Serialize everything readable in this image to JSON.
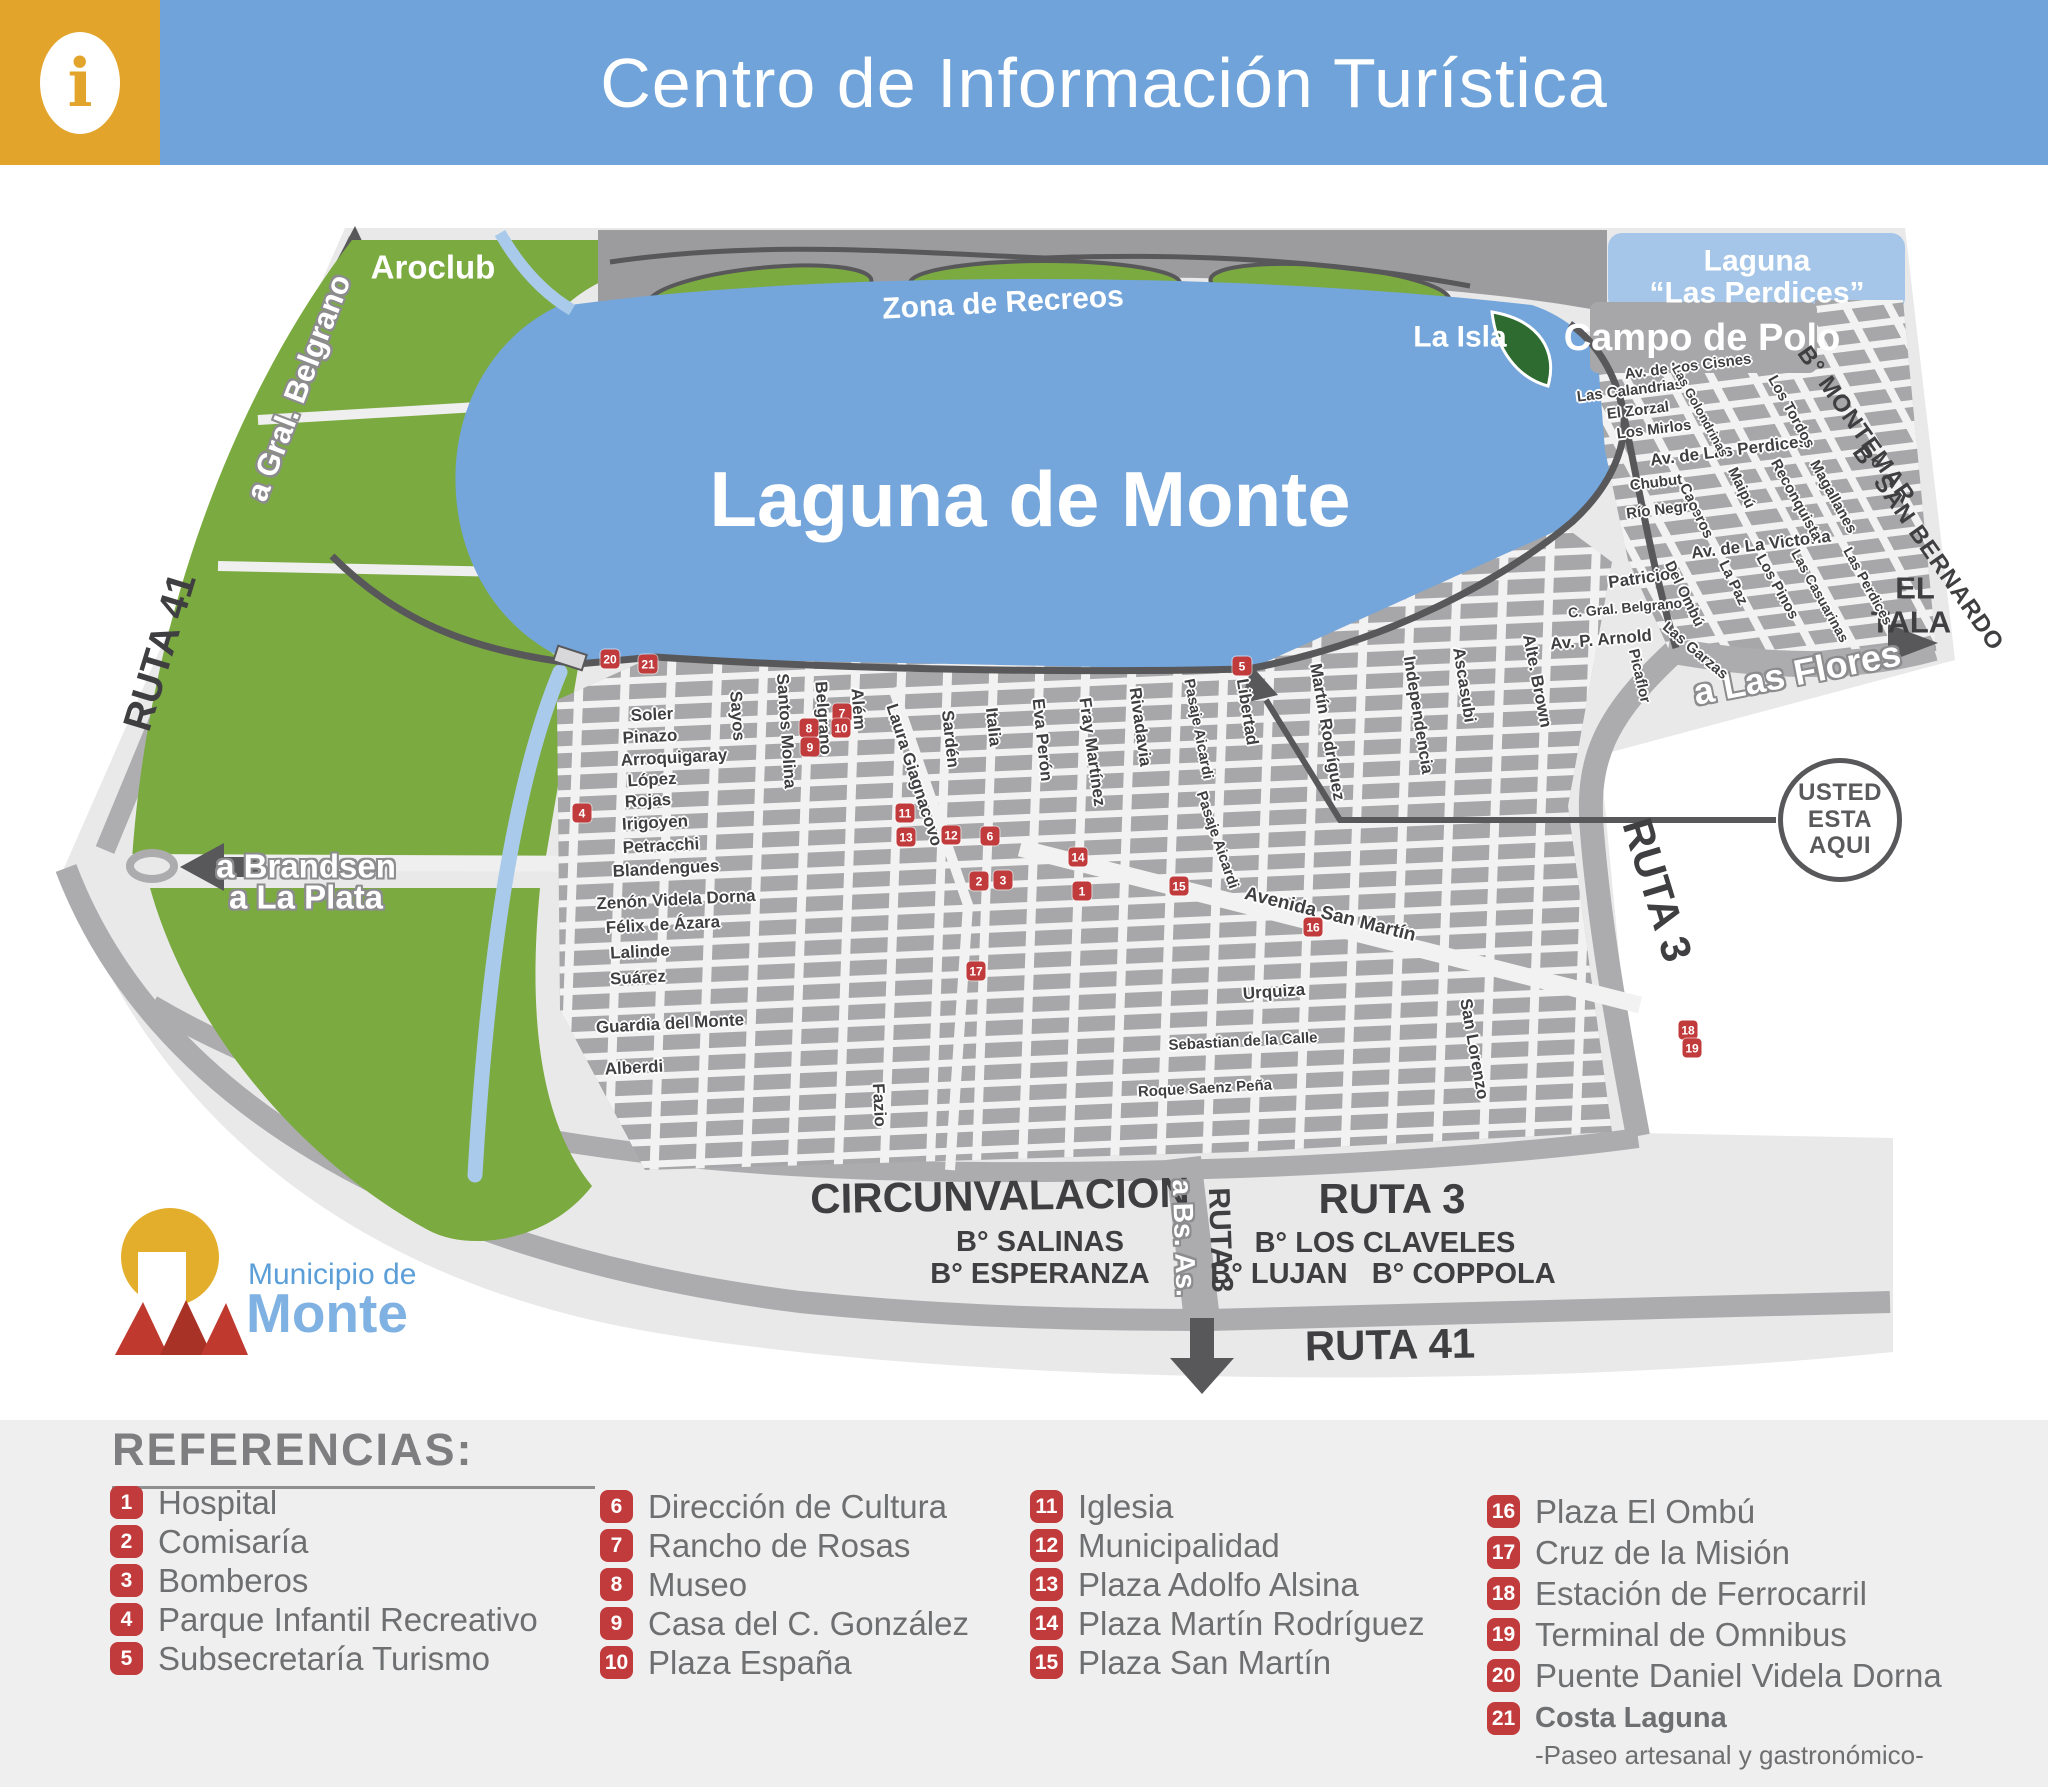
{
  "header": {
    "title": "Centro de Información Turística",
    "info_icon": "i"
  },
  "logo": {
    "line1": "Municipio de",
    "line2": "Monte"
  },
  "colors": {
    "header_blue": "#6FA3D9",
    "info_yellow": "#E2A42B",
    "lake_blue": "#74A6DB",
    "perdices_blue": "#A5C6E9",
    "park_green": "#7BAA40",
    "isla_green": "#2E6B31",
    "block_gray": "#A7A7A9",
    "plate_gray": "#E9E9EA",
    "road_dark": "#58585A",
    "marker_red": "#C23B3C",
    "legend_bg": "#EFEFEF",
    "legend_text": "#6E6F71"
  },
  "map": {
    "you_are_here": [
      "USTED",
      "ESTA",
      "AQUI"
    ],
    "labels": [
      {
        "t": "Laguna de Monte",
        "x": 1030,
        "y": 500,
        "r": 0,
        "s": 78,
        "c": "lw"
      },
      {
        "t": "Zona de Recreos",
        "x": 1003,
        "y": 303,
        "r": -3,
        "s": 30,
        "c": "lw"
      },
      {
        "t": "Aroclub",
        "x": 433,
        "y": 268,
        "r": 0,
        "s": 33,
        "c": "lw"
      },
      {
        "t": "La Isla",
        "x": 1460,
        "y": 337,
        "r": 0,
        "s": 30,
        "c": "lw"
      },
      {
        "t": "Laguna",
        "x": 1757,
        "y": 261,
        "r": 0,
        "s": 30,
        "c": "lw"
      },
      {
        "t": "“Las Perdices”",
        "x": 1757,
        "y": 293,
        "r": 0,
        "s": 30,
        "c": "lw"
      },
      {
        "t": "Campo de Polo",
        "x": 1702,
        "y": 339,
        "r": 0,
        "s": 38,
        "c": "lw"
      },
      {
        "t": "RUTA 41",
        "x": 160,
        "y": 652,
        "r": -73,
        "s": 40,
        "c": "rt"
      },
      {
        "t": "RUTA 3",
        "x": 1657,
        "y": 890,
        "r": 73,
        "s": 42,
        "c": "rt"
      },
      {
        "t": "CIRCUNVALACION",
        "x": 1000,
        "y": 1196,
        "r": -1,
        "s": 42,
        "c": "rt"
      },
      {
        "t": "B° SALINAS",
        "x": 1040,
        "y": 1242,
        "r": 0,
        "s": 29,
        "c": "rt"
      },
      {
        "t": "B° ESPERANZA",
        "x": 1040,
        "y": 1274,
        "r": 0,
        "s": 29,
        "c": "rt"
      },
      {
        "t": "RUTA 3",
        "x": 1392,
        "y": 1199,
        "r": 0,
        "s": 42,
        "c": "rt"
      },
      {
        "t": "B° LOS CLAVELES",
        "x": 1385,
        "y": 1243,
        "r": 0,
        "s": 29,
        "c": "rt"
      },
      {
        "t": "B° LUJAN   B° COPPOLA",
        "x": 1383,
        "y": 1274,
        "r": 0,
        "s": 29,
        "c": "rt"
      },
      {
        "t": "RUTA 41",
        "x": 1390,
        "y": 1345,
        "r": -1,
        "s": 42,
        "c": "rt"
      },
      {
        "t": "RUTA 3",
        "x": 1220,
        "y": 1240,
        "r": 88,
        "s": 30,
        "c": "rt"
      },
      {
        "t": "EL",
        "x": 1915,
        "y": 589,
        "r": 0,
        "s": 31,
        "c": "rt"
      },
      {
        "t": "TALA",
        "x": 1911,
        "y": 623,
        "r": 0,
        "s": 31,
        "c": "rt"
      },
      {
        "t": "B° MONTEMAR",
        "x": 1856,
        "y": 425,
        "r": 55,
        "s": 24,
        "c": "bn"
      },
      {
        "t": "B° SAN BERNARDO",
        "x": 1928,
        "y": 548,
        "r": 55,
        "s": 24,
        "c": "bn"
      },
      {
        "t": "a Gral. Belgrano",
        "x": 299,
        "y": 388,
        "r": -69,
        "s": 31,
        "c": "sw"
      },
      {
        "t": "a Brandsen",
        "x": 306,
        "y": 867,
        "r": 0,
        "s": 33,
        "c": "sw"
      },
      {
        "t": "a La Plata",
        "x": 306,
        "y": 898,
        "r": 0,
        "s": 33,
        "c": "sw"
      },
      {
        "t": "a Las Flores",
        "x": 1797,
        "y": 673,
        "r": -11,
        "s": 36,
        "c": "sw"
      },
      {
        "t": "a Bs. As.",
        "x": 1184,
        "y": 1238,
        "r": 88,
        "s": 28,
        "c": "sw"
      },
      {
        "t": "Soler",
        "x": 652,
        "y": 715,
        "r": -3,
        "s": 17,
        "c": "st"
      },
      {
        "t": "Pinazo",
        "x": 650,
        "y": 737,
        "r": -3,
        "s": 17,
        "c": "st"
      },
      {
        "t": "Arroquigaray",
        "x": 674,
        "y": 758,
        "r": -3,
        "s": 17,
        "c": "st"
      },
      {
        "t": "López",
        "x": 652,
        "y": 780,
        "r": -3,
        "s": 17,
        "c": "st"
      },
      {
        "t": "Rojas",
        "x": 648,
        "y": 801,
        "r": -3,
        "s": 17,
        "c": "st"
      },
      {
        "t": "Irigoyen",
        "x": 655,
        "y": 823,
        "r": -3,
        "s": 17,
        "c": "st"
      },
      {
        "t": "Petracchi",
        "x": 661,
        "y": 846,
        "r": -3,
        "s": 17,
        "c": "st"
      },
      {
        "t": "Blandengues",
        "x": 666,
        "y": 869,
        "r": -3,
        "s": 17,
        "c": "st"
      },
      {
        "t": "Zenón Videla Dorna",
        "x": 676,
        "y": 900,
        "r": -3,
        "s": 17,
        "c": "st"
      },
      {
        "t": "Félix de Ázara",
        "x": 663,
        "y": 925,
        "r": -3,
        "s": 17,
        "c": "st"
      },
      {
        "t": "Lalinde",
        "x": 640,
        "y": 952,
        "r": -3,
        "s": 17,
        "c": "st"
      },
      {
        "t": "Suárez",
        "x": 638,
        "y": 978,
        "r": -3,
        "s": 17,
        "c": "st"
      },
      {
        "t": "Guardia del Monte",
        "x": 670,
        "y": 1024,
        "r": -3,
        "s": 17,
        "c": "st"
      },
      {
        "t": "Alberdi",
        "x": 634,
        "y": 1068,
        "r": -3,
        "s": 17,
        "c": "st"
      },
      {
        "t": "Urquiza",
        "x": 1274,
        "y": 992,
        "r": -4,
        "s": 17,
        "c": "st"
      },
      {
        "t": "Sebastian de la Calle",
        "x": 1243,
        "y": 1042,
        "r": -3,
        "s": 15,
        "c": "st"
      },
      {
        "t": "Roque Saenz Peña",
        "x": 1205,
        "y": 1089,
        "r": -3,
        "s": 15,
        "c": "st"
      },
      {
        "t": "Sayos",
        "x": 737,
        "y": 716,
        "r": 86,
        "s": 17,
        "c": "st"
      },
      {
        "t": "Santos Molina",
        "x": 786,
        "y": 731,
        "r": 86,
        "s": 17,
        "c": "st"
      },
      {
        "t": "Belgrano",
        "x": 823,
        "y": 718,
        "r": 86,
        "s": 17,
        "c": "st"
      },
      {
        "t": "Além",
        "x": 858,
        "y": 709,
        "r": 86,
        "s": 17,
        "c": "st"
      },
      {
        "t": "Laura Giagnacovo",
        "x": 914,
        "y": 775,
        "r": 72,
        "s": 17,
        "c": "st"
      },
      {
        "t": "Sardén",
        "x": 950,
        "y": 739,
        "r": 84,
        "s": 17,
        "c": "st"
      },
      {
        "t": "Italia",
        "x": 993,
        "y": 727,
        "r": 84,
        "s": 17,
        "c": "st"
      },
      {
        "t": "Eva Perón",
        "x": 1042,
        "y": 740,
        "r": 84,
        "s": 17,
        "c": "st"
      },
      {
        "t": "Fray Martínez",
        "x": 1092,
        "y": 752,
        "r": 82,
        "s": 17,
        "c": "st"
      },
      {
        "t": "Rivadavia",
        "x": 1140,
        "y": 727,
        "r": 82,
        "s": 17,
        "c": "st"
      },
      {
        "t": "Pasaje Aicardi",
        "x": 1198,
        "y": 729,
        "r": 79,
        "s": 15,
        "c": "st"
      },
      {
        "t": "Libertad",
        "x": 1247,
        "y": 712,
        "r": 81,
        "s": 17,
        "c": "st"
      },
      {
        "t": "Pasaje Aicardi",
        "x": 1217,
        "y": 840,
        "r": 71,
        "s": 15,
        "c": "st"
      },
      {
        "t": "Avenida San Martín",
        "x": 1330,
        "y": 915,
        "r": 14,
        "s": 19,
        "c": "st"
      },
      {
        "t": "San Lorenzo",
        "x": 1474,
        "y": 1049,
        "r": 80,
        "s": 17,
        "c": "st"
      },
      {
        "t": "Martín Rodríguez",
        "x": 1327,
        "y": 732,
        "r": 80,
        "s": 17,
        "c": "st"
      },
      {
        "t": "Independencia",
        "x": 1418,
        "y": 715,
        "r": 81,
        "s": 17,
        "c": "st"
      },
      {
        "t": "Ascasubi",
        "x": 1464,
        "y": 685,
        "r": 81,
        "s": 17,
        "c": "st"
      },
      {
        "t": "Alte. Brown",
        "x": 1537,
        "y": 681,
        "r": 79,
        "s": 17,
        "c": "st"
      },
      {
        "t": "Fazio",
        "x": 879,
        "y": 1105,
        "r": 87,
        "s": 17,
        "c": "st"
      },
      {
        "t": "Av. P. Arnold",
        "x": 1601,
        "y": 640,
        "r": -5,
        "s": 17,
        "c": "st"
      },
      {
        "t": "Picaflor",
        "x": 1639,
        "y": 676,
        "r": 77,
        "s": 15,
        "c": "st"
      },
      {
        "t": "Las Garzas",
        "x": 1695,
        "y": 651,
        "r": 40,
        "s": 15,
        "c": "st"
      },
      {
        "t": "C. Gral. Belgrano",
        "x": 1625,
        "y": 608,
        "r": -5,
        "s": 14,
        "c": "st"
      },
      {
        "t": "Patricios",
        "x": 1644,
        "y": 578,
        "r": -8,
        "s": 17,
        "c": "st"
      },
      {
        "t": "Del Ombú",
        "x": 1684,
        "y": 594,
        "r": 64,
        "s": 15,
        "c": "st"
      },
      {
        "t": "La Paz",
        "x": 1733,
        "y": 583,
        "r": 64,
        "s": 15,
        "c": "st"
      },
      {
        "t": "Los Pinos",
        "x": 1777,
        "y": 587,
        "r": 61,
        "s": 15,
        "c": "st"
      },
      {
        "t": "Las Casuarinas",
        "x": 1820,
        "y": 596,
        "r": 61,
        "s": 14,
        "c": "st"
      },
      {
        "t": "Las Perdices",
        "x": 1868,
        "y": 586,
        "r": 61,
        "s": 14,
        "c": "st"
      },
      {
        "t": "Av. de La Victoria",
        "x": 1761,
        "y": 545,
        "r": -7,
        "s": 17,
        "c": "st"
      },
      {
        "t": "Caseros",
        "x": 1696,
        "y": 511,
        "r": 64,
        "s": 15,
        "c": "st"
      },
      {
        "t": "Maipú",
        "x": 1741,
        "y": 488,
        "r": 64,
        "s": 15,
        "c": "st"
      },
      {
        "t": "Reconquista",
        "x": 1796,
        "y": 500,
        "r": 61,
        "s": 15,
        "c": "st"
      },
      {
        "t": "Magallanes",
        "x": 1833,
        "y": 497,
        "r": 61,
        "s": 15,
        "c": "st"
      },
      {
        "t": "Chubut",
        "x": 1656,
        "y": 483,
        "r": -7,
        "s": 15,
        "c": "st"
      },
      {
        "t": "Río Negro",
        "x": 1662,
        "y": 510,
        "r": -7,
        "s": 15,
        "c": "st"
      },
      {
        "t": "Av. de Las Perdices",
        "x": 1729,
        "y": 451,
        "r": -7,
        "s": 17,
        "c": "st"
      },
      {
        "t": "Los Mirlos",
        "x": 1654,
        "y": 430,
        "r": -7,
        "s": 15,
        "c": "st"
      },
      {
        "t": "El Zorzal",
        "x": 1638,
        "y": 411,
        "r": -7,
        "s": 15,
        "c": "st"
      },
      {
        "t": "Las Calandrias",
        "x": 1630,
        "y": 391,
        "r": -7,
        "s": 15,
        "c": "st"
      },
      {
        "t": "Av. de Los Cisnes",
        "x": 1688,
        "y": 367,
        "r": -7,
        "s": 15,
        "c": "st"
      },
      {
        "t": "Las Golondrinas",
        "x": 1700,
        "y": 411,
        "r": 61,
        "s": 13,
        "c": "st"
      },
      {
        "t": "Los Tordos",
        "x": 1791,
        "y": 412,
        "r": 61,
        "s": 15,
        "c": "st"
      }
    ],
    "markers": [
      {
        "n": "1",
        "x": 1082,
        "y": 891
      },
      {
        "n": "2",
        "x": 979,
        "y": 881
      },
      {
        "n": "3",
        "x": 1003,
        "y": 880
      },
      {
        "n": "4",
        "x": 582,
        "y": 813
      },
      {
        "n": "5",
        "x": 1242,
        "y": 666
      },
      {
        "n": "6",
        "x": 990,
        "y": 836
      },
      {
        "n": "7",
        "x": 842,
        "y": 713
      },
      {
        "n": "8",
        "x": 809,
        "y": 728
      },
      {
        "n": "9",
        "x": 810,
        "y": 747
      },
      {
        "n": "10",
        "x": 841,
        "y": 728
      },
      {
        "n": "11",
        "x": 905,
        "y": 813
      },
      {
        "n": "12",
        "x": 951,
        "y": 835
      },
      {
        "n": "13",
        "x": 906,
        "y": 837
      },
      {
        "n": "14",
        "x": 1078,
        "y": 857
      },
      {
        "n": "15",
        "x": 1179,
        "y": 886
      },
      {
        "n": "16",
        "x": 1313,
        "y": 927
      },
      {
        "n": "17",
        "x": 976,
        "y": 971
      },
      {
        "n": "18",
        "x": 1688,
        "y": 1030
      },
      {
        "n": "19",
        "x": 1692,
        "y": 1048
      },
      {
        "n": "20",
        "x": 610,
        "y": 659
      },
      {
        "n": "21",
        "x": 648,
        "y": 664
      }
    ]
  },
  "legend": {
    "heading": "REFERENCIAS:",
    "columns": [
      [
        {
          "n": "1",
          "t": "Hospital"
        },
        {
          "n": "2",
          "t": "Comisaría"
        },
        {
          "n": "3",
          "t": "Bomberos"
        },
        {
          "n": "4",
          "t": "Parque Infantil Recreativo"
        },
        {
          "n": "5",
          "t": "Subsecretaría Turismo"
        }
      ],
      [
        {
          "n": "6",
          "t": "Dirección de Cultura"
        },
        {
          "n": "7",
          "t": "Rancho de Rosas"
        },
        {
          "n": "8",
          "t": "Museo"
        },
        {
          "n": "9",
          "t": "Casa del C. González"
        },
        {
          "n": "10",
          "t": "Plaza España"
        }
      ],
      [
        {
          "n": "11",
          "t": "Iglesia"
        },
        {
          "n": "12",
          "t": "Municipalidad"
        },
        {
          "n": "13",
          "t": "Plaza Adolfo Alsina"
        },
        {
          "n": "14",
          "t": "Plaza Martín Rodríguez"
        },
        {
          "n": "15",
          "t": "Plaza San Martín"
        }
      ],
      [
        {
          "n": "16",
          "t": "Plaza El Ombú"
        },
        {
          "n": "17",
          "t": "Cruz de la Misión"
        },
        {
          "n": "18",
          "t": "Estación de Ferrocarril"
        },
        {
          "n": "19",
          "t": "Terminal de Omnibus"
        },
        {
          "n": "20",
          "t": "Puente Daniel Videla Dorna"
        },
        {
          "n": "21",
          "t": "Costa Laguna",
          "sub": "-Paseo artesanal y gastronómico-",
          "bold": true
        }
      ]
    ]
  }
}
